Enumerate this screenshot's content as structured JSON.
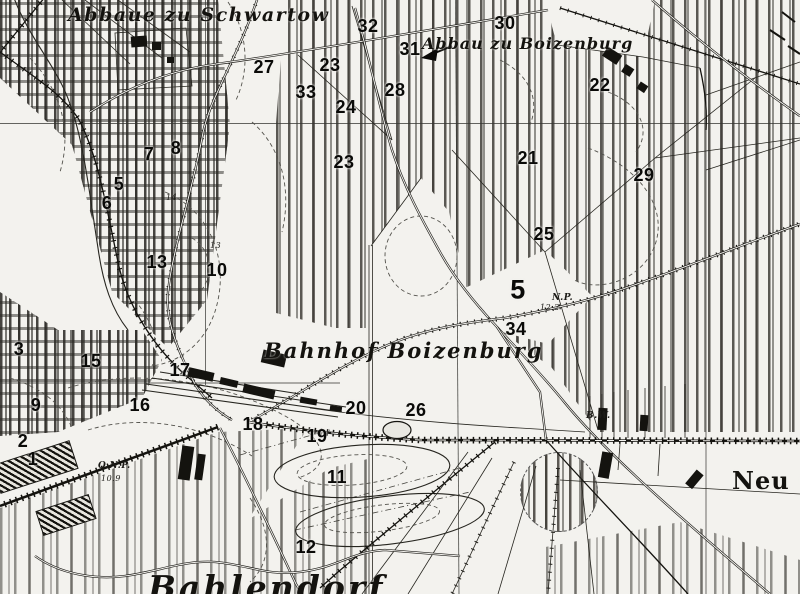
{
  "map": {
    "description": "Historical black-and-white topographic map extract around a railway station, with bold numeric overlay markers 1-34",
    "colors": {
      "paper": "#f3f2ee",
      "ink": "#14130f"
    },
    "place_labels": [
      {
        "text": "Abbaue zu Schwartow",
        "x": 68,
        "y": 4,
        "cls": "lbl-cursive lbl-schwartow"
      },
      {
        "text": "Abbau zu Boizenburg",
        "x": 422,
        "y": 34,
        "cls": "lbl-cursive lbl-abbau"
      },
      {
        "text": "Bahnhof  Boizenburg",
        "x": 264,
        "y": 338,
        "cls": "lbl-cursive lbl-bahnhof"
      },
      {
        "text": "Bahlendorf",
        "x": 148,
        "y": 568,
        "cls": "lbl-cursive lbl-bahlendorf"
      },
      {
        "text": "Neu G",
        "x": 732,
        "y": 466,
        "cls": "lbl-neu"
      }
    ],
    "annotations": [
      {
        "text": "B.W.",
        "x": 586,
        "y": 412
      },
      {
        "text": "N.P.",
        "x": 552,
        "y": 294
      },
      {
        "text": "12.2",
        "x": 540,
        "y": 304,
        "cls": "tiny"
      },
      {
        "text": "O.N.P.",
        "x": 98,
        "y": 462
      },
      {
        "text": "10.9",
        "x": 101,
        "y": 475,
        "cls": "tiny"
      },
      {
        "text": "14",
        "x": 166,
        "y": 194,
        "cls": "tiny"
      },
      {
        "text": "13",
        "x": 210,
        "y": 242,
        "cls": "tiny"
      }
    ],
    "markers": [
      {
        "text": "1",
        "x": 33,
        "y": 459
      },
      {
        "text": "2",
        "x": 23,
        "y": 441
      },
      {
        "text": "3",
        "x": 19,
        "y": 349
      },
      {
        "text": "5",
        "x": 119,
        "y": 184
      },
      {
        "text": "6",
        "x": 107,
        "y": 203
      },
      {
        "text": "7",
        "x": 149,
        "y": 154
      },
      {
        "text": "8",
        "x": 176,
        "y": 148
      },
      {
        "text": "9",
        "x": 36,
        "y": 405
      },
      {
        "text": "10",
        "x": 217,
        "y": 270
      },
      {
        "text": "11",
        "x": 337,
        "y": 477
      },
      {
        "text": "12",
        "x": 306,
        "y": 547
      },
      {
        "text": "13",
        "x": 157,
        "y": 262
      },
      {
        "text": "15",
        "x": 91,
        "y": 361
      },
      {
        "text": "16",
        "x": 140,
        "y": 405
      },
      {
        "text": "17",
        "x": 180,
        "y": 370
      },
      {
        "text": "18",
        "x": 253,
        "y": 424
      },
      {
        "text": "19",
        "x": 317,
        "y": 436
      },
      {
        "text": "20",
        "x": 356,
        "y": 408
      },
      {
        "text": "21",
        "x": 528,
        "y": 158
      },
      {
        "text": "22",
        "x": 600,
        "y": 85
      },
      {
        "text": "23",
        "x": 330,
        "y": 65
      },
      {
        "text": "23",
        "x": 344,
        "y": 162
      },
      {
        "text": "24",
        "x": 346,
        "y": 107
      },
      {
        "text": "25",
        "x": 544,
        "y": 234
      },
      {
        "text": "26",
        "x": 416,
        "y": 410
      },
      {
        "text": "27",
        "x": 264,
        "y": 67
      },
      {
        "text": "28",
        "x": 395,
        "y": 90
      },
      {
        "text": "29",
        "x": 644,
        "y": 175
      },
      {
        "text": "30",
        "x": 505,
        "y": 23
      },
      {
        "text": "31",
        "x": 410,
        "y": 49
      },
      {
        "text": "32",
        "x": 368,
        "y": 26
      },
      {
        "text": "33",
        "x": 306,
        "y": 92
      },
      {
        "text": "34",
        "x": 516,
        "y": 329
      },
      {
        "text": "5",
        "x": 518,
        "y": 290,
        "big": true
      }
    ]
  }
}
